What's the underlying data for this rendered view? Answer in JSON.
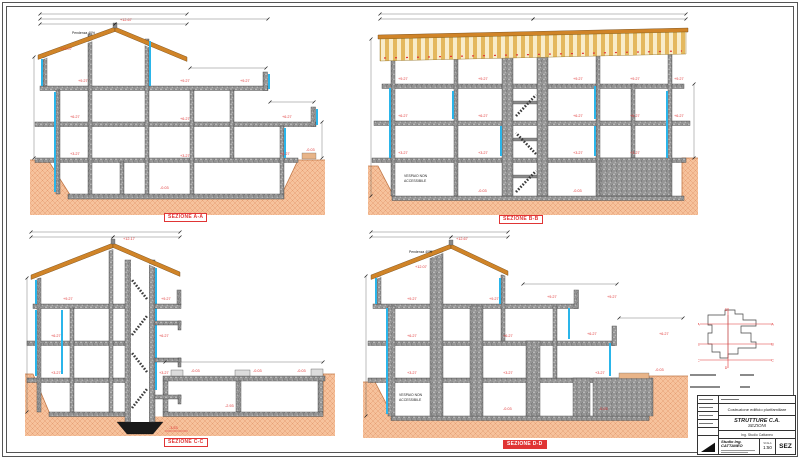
{
  "title_block": {
    "project": "Costruzione edificio plurifamiliare",
    "title": "STRUTTURE C.A.",
    "subtitle": "SEZIONI",
    "firm_row": "Ing. Studio Cattaneo",
    "firm": "Studio Ing. CATTANEO",
    "scale_label": "SCALA",
    "scale": "1:50",
    "code": "SEZ"
  },
  "key_plan": {
    "marks": [
      "A",
      "B",
      "C",
      "D"
    ]
  },
  "colors": {
    "concrete": "#949494",
    "wood": "#d08428",
    "wood_light": "#e4b85e",
    "insulation": "#2ab5ea",
    "terrain": "#f6c29c",
    "accent_red": "#e03535"
  },
  "sections": [
    {
      "id": "A",
      "label": "SEZIONE A-A",
      "roof_note": {
        "t": "Pendenza 40%",
        "x": 42,
        "y": 26
      },
      "elevations": [
        {
          "t": "+12.67",
          "x": 90,
          "y": 13
        },
        {
          "t": "+12.07",
          "x": 30,
          "y": 42
        },
        {
          "t": "+9.27",
          "x": 48,
          "y": 74
        },
        {
          "t": "+9.27",
          "x": 150,
          "y": 74
        },
        {
          "t": "+9.27",
          "x": 210,
          "y": 74
        },
        {
          "t": "+6.27",
          "x": 40,
          "y": 110
        },
        {
          "t": "+6.27",
          "x": 150,
          "y": 112
        },
        {
          "t": "+6.27",
          "x": 252,
          "y": 110
        },
        {
          "t": "+3.27",
          "x": 40,
          "y": 147
        },
        {
          "t": "+3.27",
          "x": 150,
          "y": 149
        },
        {
          "t": "+3.27",
          "x": 250,
          "y": 147
        },
        {
          "t": "-0.03",
          "x": 130,
          "y": 181
        },
        {
          "t": "-0.03",
          "x": 276,
          "y": 143
        }
      ]
    },
    {
      "id": "B",
      "label": "SEZIONE B-B",
      "notes": [
        {
          "t": "VESPAIO NON",
          "x": 36,
          "y": 169
        },
        {
          "t": "ACCESSIBILE",
          "x": 36,
          "y": 174
        }
      ],
      "elevations": [
        {
          "t": "+9.27",
          "x": 30,
          "y": 72
        },
        {
          "t": "+9.27",
          "x": 110,
          "y": 72
        },
        {
          "t": "+9.27",
          "x": 205,
          "y": 72
        },
        {
          "t": "+9.27",
          "x": 262,
          "y": 72
        },
        {
          "t": "+9.27",
          "x": 306,
          "y": 72
        },
        {
          "t": "+6.27",
          "x": 30,
          "y": 109
        },
        {
          "t": "+6.27",
          "x": 110,
          "y": 109
        },
        {
          "t": "+6.27",
          "x": 205,
          "y": 109
        },
        {
          "t": "+6.27",
          "x": 262,
          "y": 109
        },
        {
          "t": "+6.27",
          "x": 306,
          "y": 109
        },
        {
          "t": "+3.27",
          "x": 30,
          "y": 146
        },
        {
          "t": "+3.27",
          "x": 110,
          "y": 146
        },
        {
          "t": "+3.27",
          "x": 205,
          "y": 146
        },
        {
          "t": "+3.27",
          "x": 262,
          "y": 146
        },
        {
          "t": "-0.03",
          "x": 110,
          "y": 184
        },
        {
          "t": "-0.03",
          "x": 205,
          "y": 184
        }
      ]
    },
    {
      "id": "C",
      "label": "SEZIONE C-C",
      "elevations": [
        {
          "t": "+12.17",
          "x": 98,
          "y": 14
        },
        {
          "t": "+9.27",
          "x": 38,
          "y": 74
        },
        {
          "t": "+9.27",
          "x": 136,
          "y": 74
        },
        {
          "t": "+6.27",
          "x": 26,
          "y": 111
        },
        {
          "t": "+6.27",
          "x": 134,
          "y": 111
        },
        {
          "t": "+3.27",
          "x": 26,
          "y": 148
        },
        {
          "t": "+3.27",
          "x": 134,
          "y": 148
        },
        {
          "t": "-0.03",
          "x": 166,
          "y": 146
        },
        {
          "t": "-0.03",
          "x": 228,
          "y": 146
        },
        {
          "t": "-0.03",
          "x": 272,
          "y": 146
        },
        {
          "t": "-2.93",
          "x": 200,
          "y": 181
        },
        {
          "t": "-3.53",
          "x": 144,
          "y": 203
        }
      ]
    },
    {
      "id": "D",
      "label": "SEZIONE D-D",
      "roof_note": {
        "t": "Pendenza 40%",
        "x": 46,
        "y": 27
      },
      "notes": [
        {
          "t": "VESPAIO NON",
          "x": 36,
          "y": 170
        },
        {
          "t": "ACCESSIBILE",
          "x": 36,
          "y": 175
        }
      ],
      "elevations": [
        {
          "t": "+12.67",
          "x": 93,
          "y": 14
        },
        {
          "t": "+12.07",
          "x": 52,
          "y": 42
        },
        {
          "t": "+9.27",
          "x": 44,
          "y": 74
        },
        {
          "t": "+9.27",
          "x": 126,
          "y": 74
        },
        {
          "t": "+9.27",
          "x": 184,
          "y": 72
        },
        {
          "t": "+9.27",
          "x": 244,
          "y": 72
        },
        {
          "t": "+6.27",
          "x": 44,
          "y": 111
        },
        {
          "t": "+6.27",
          "x": 140,
          "y": 111
        },
        {
          "t": "+6.27",
          "x": 224,
          "y": 109
        },
        {
          "t": "+6.27",
          "x": 296,
          "y": 109
        },
        {
          "t": "+3.27",
          "x": 44,
          "y": 148
        },
        {
          "t": "+3.27",
          "x": 140,
          "y": 148
        },
        {
          "t": "+3.27",
          "x": 232,
          "y": 148
        },
        {
          "t": "-0.03",
          "x": 140,
          "y": 184
        },
        {
          "t": "-0.03",
          "x": 236,
          "y": 184
        },
        {
          "t": "-0.03",
          "x": 292,
          "y": 145
        }
      ]
    }
  ]
}
